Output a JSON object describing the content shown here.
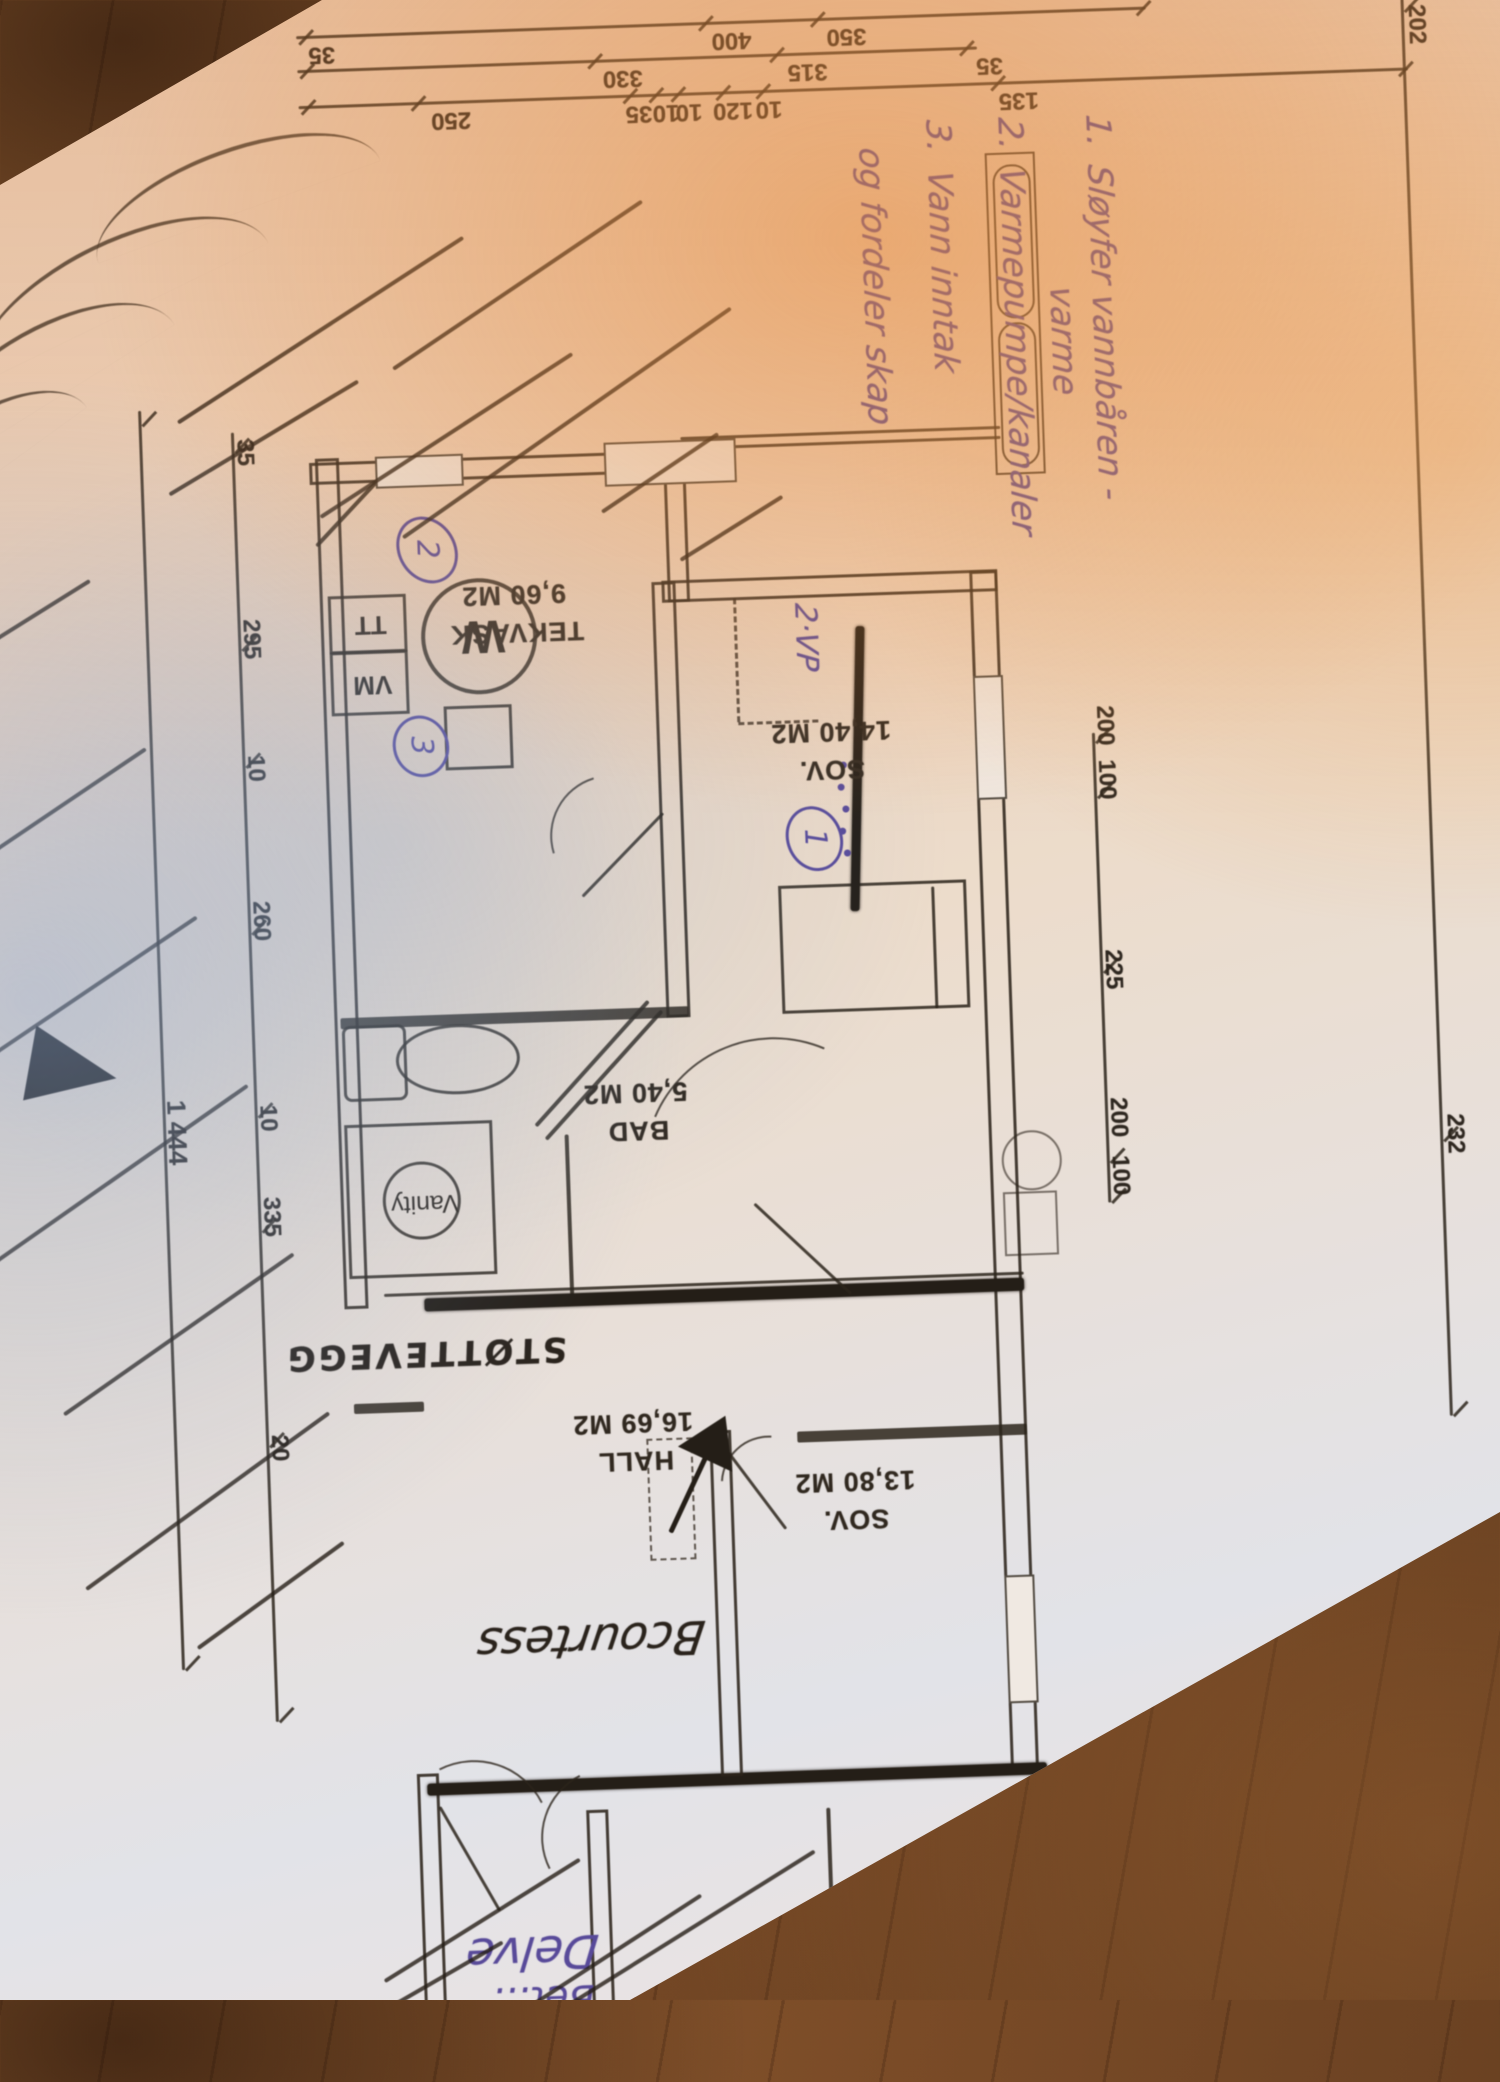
{
  "photo": {
    "paper_color": "#ece2da",
    "ink_color": "#2c241b",
    "handwriting_ink": "#584a99",
    "wood_color": "#7a4b27"
  },
  "plan": {
    "rooms": [
      {
        "name": "TEKVASK",
        "area": "9,60 M2"
      },
      {
        "name": "SOV.",
        "area": "14,40 M2"
      },
      {
        "name": "BAD",
        "area": "5,40 M2"
      },
      {
        "name": "HALL",
        "area": "16,69 M2"
      },
      {
        "name": "SOV.",
        "area": "13,80 M2"
      }
    ],
    "annex": {
      "area": "15,42 M2",
      "status": "IKKE UTLEIED"
    },
    "fixtures": {
      "washer": "VM",
      "dryer": "TT",
      "heater": "W",
      "vanity": "Vanity"
    }
  },
  "handwriting": {
    "notes": [
      {
        "num": "1.",
        "line1": "Sløyfer vannbåren -",
        "line2": "varme"
      },
      {
        "num": "2.",
        "line1": "Varmepumpe/kanaler",
        "line2": ""
      },
      {
        "num": "3.",
        "line1": "Vann inntak",
        "line2": "og fordeler skap"
      }
    ],
    "markers": [
      "1",
      "2",
      "3"
    ],
    "vp": "2·VP",
    "wall": "STØTTEVEGG",
    "hall_script": "Bcourtess",
    "bottom_script": "Delve",
    "bottom_script2": "Bet…"
  },
  "dims": {
    "row1": [
      "350",
      "400",
      "35"
    ],
    "row2": [
      "35",
      "315",
      "330"
    ],
    "row3": [
      "135",
      "10",
      "120",
      "10",
      "10",
      "35",
      "250"
    ],
    "left_far": [
      "202",
      "232"
    ],
    "left_near": [
      "100",
      "200",
      "225",
      "100",
      "200"
    ],
    "right_chain": [
      "35",
      "295",
      "10",
      "260",
      "10",
      "335",
      "20"
    ],
    "overall": "1 444"
  }
}
